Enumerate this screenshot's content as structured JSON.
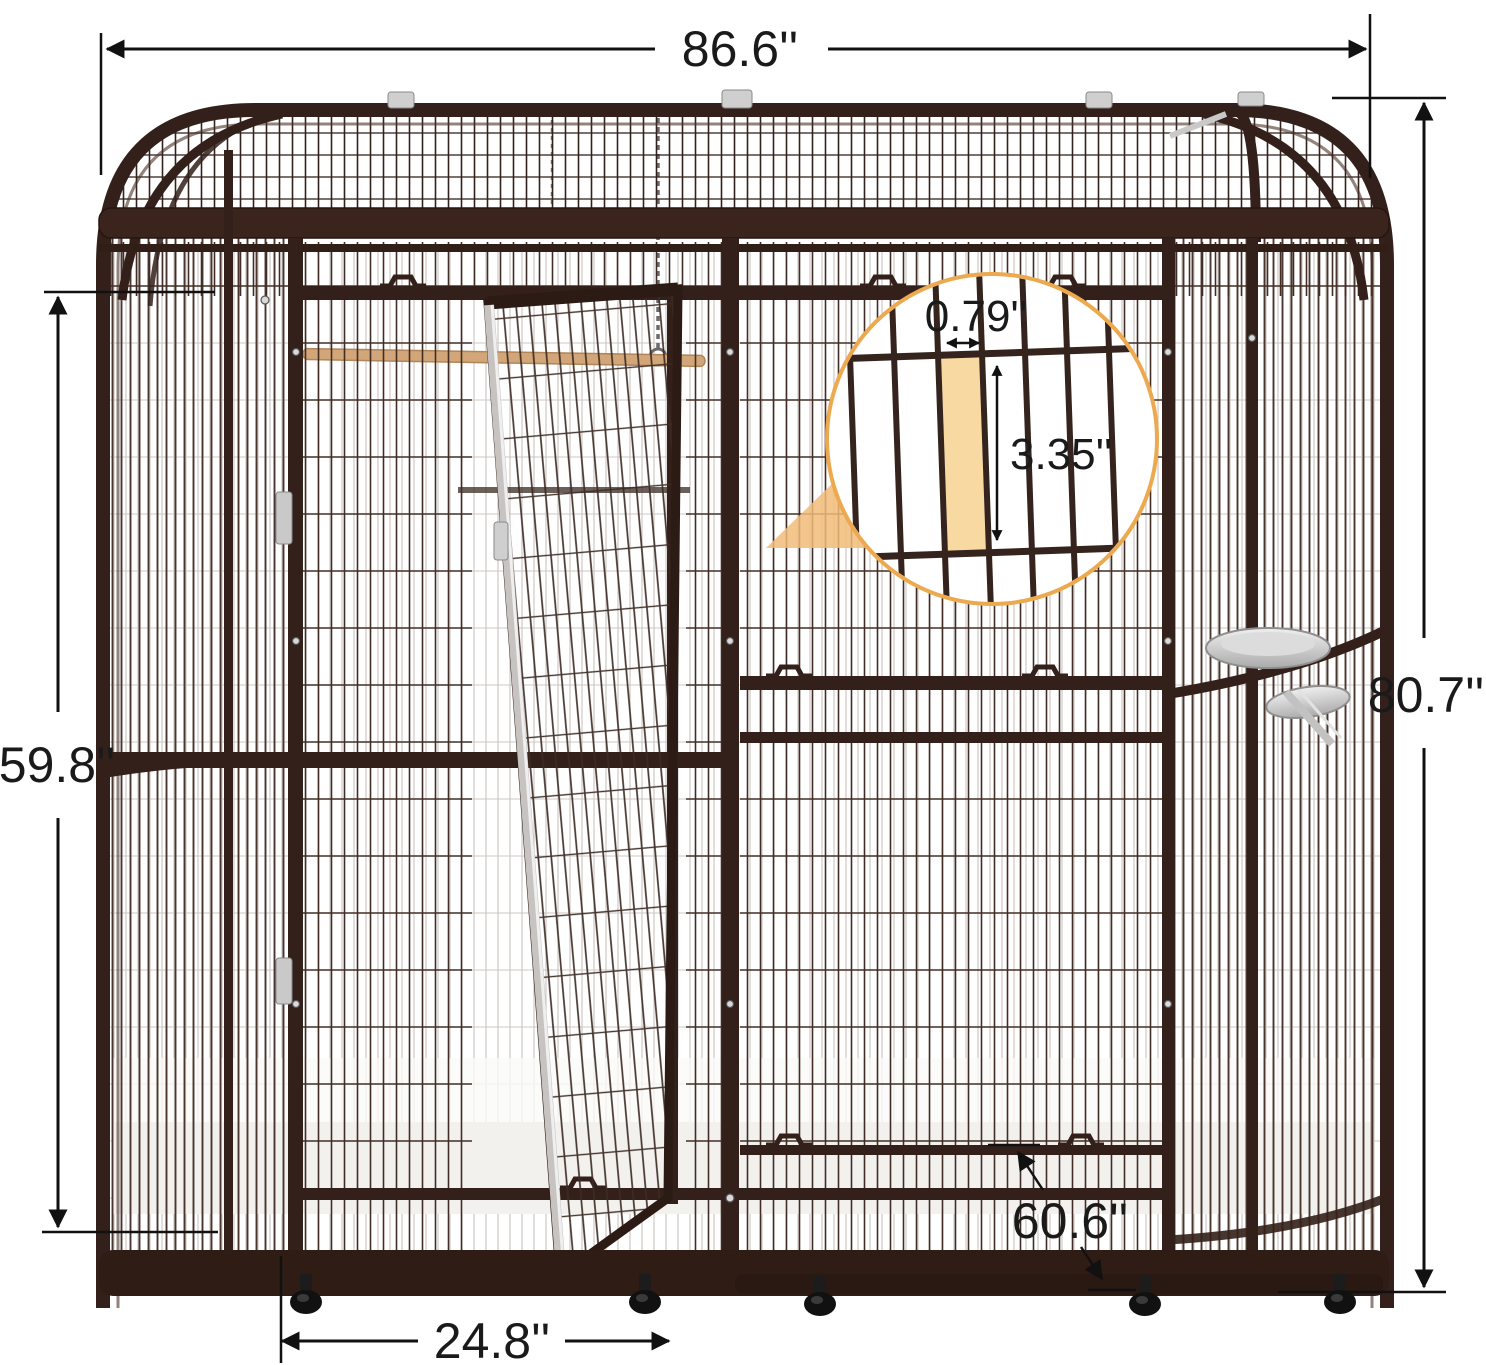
{
  "diagram": {
    "subject": "large walk-in bird cage aviary with dimension annotations",
    "dimensions": {
      "overall_width": "86.6''",
      "overall_height": "80.7''",
      "side_height": "59.8''",
      "door_width": "24.8''",
      "depth": "60.6''"
    },
    "wire_detail": {
      "bar_gap_width": "0.79''",
      "bar_gap_height": "3.35''"
    },
    "colors": {
      "frame": "#33201a",
      "mesh": "#412d25",
      "accent_ring": "#eda94f",
      "highlight_fill": "#f8d9a2",
      "callout_wedge": "#f1bc79",
      "dimension_ink": "#1a1a1a",
      "perch": "#d2a678",
      "hardware": "#c9c9c9"
    }
  }
}
